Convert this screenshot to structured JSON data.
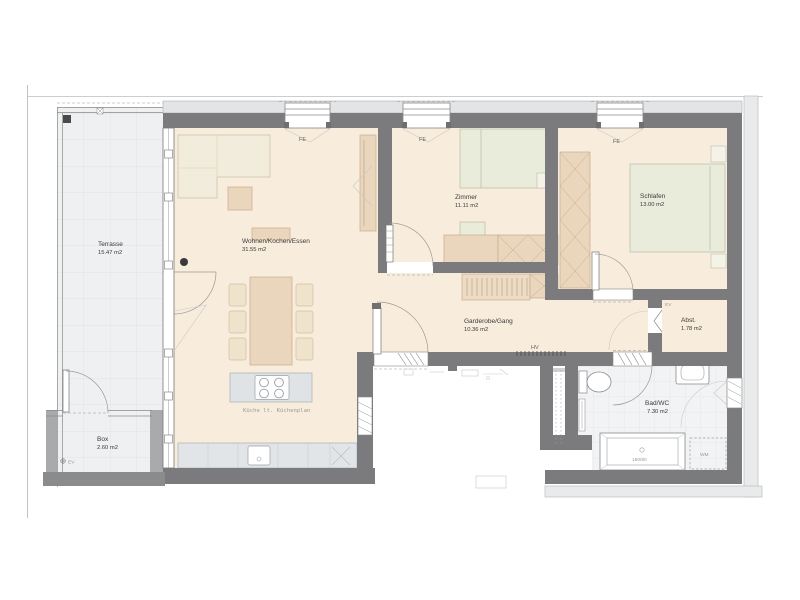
{
  "plan_title": "apartment-floor-plan",
  "rooms": [
    {
      "id": "terrasse",
      "name": "Terrasse",
      "area": "15.47 m2"
    },
    {
      "id": "wohnen",
      "name": "Wohnen/Kochen/Essen",
      "area": "31.55 m2"
    },
    {
      "id": "zimmer",
      "name": "Zimmer",
      "area": "11.11 m2"
    },
    {
      "id": "schlafen",
      "name": "Schlafen",
      "area": "13.00 m2"
    },
    {
      "id": "garderobe",
      "name": "Garderobe/Gang",
      "area": "10.36 m2"
    },
    {
      "id": "abstellraum",
      "name": "Abst.",
      "area": "1.78 m2"
    },
    {
      "id": "bad",
      "name": "Bad/WC",
      "area": "7.30 m2"
    },
    {
      "id": "box",
      "name": "Box",
      "area": "2.60 m2"
    }
  ],
  "labels": {
    "fe": "FE",
    "hv": "HV",
    "ev": "EV",
    "wm": "WM",
    "bathtub_size": "180/80",
    "kitchen_note": "Küche lt. Küchenplan"
  },
  "colors": {
    "wall": "#7b7b7d",
    "wall_light": "#a9aaac",
    "floor": "#f8ecdc",
    "floor_bad": "#f2f3f5",
    "terrace": "#eef0f2",
    "furniture_tan": "#e9d6bd",
    "furniture_tan_border": "#c9ab8a",
    "furniture_green": "#e9ebdb",
    "furniture_green_border": "#b9bda8",
    "counter": "#e2e5e8",
    "text": "#3b3b3b"
  }
}
